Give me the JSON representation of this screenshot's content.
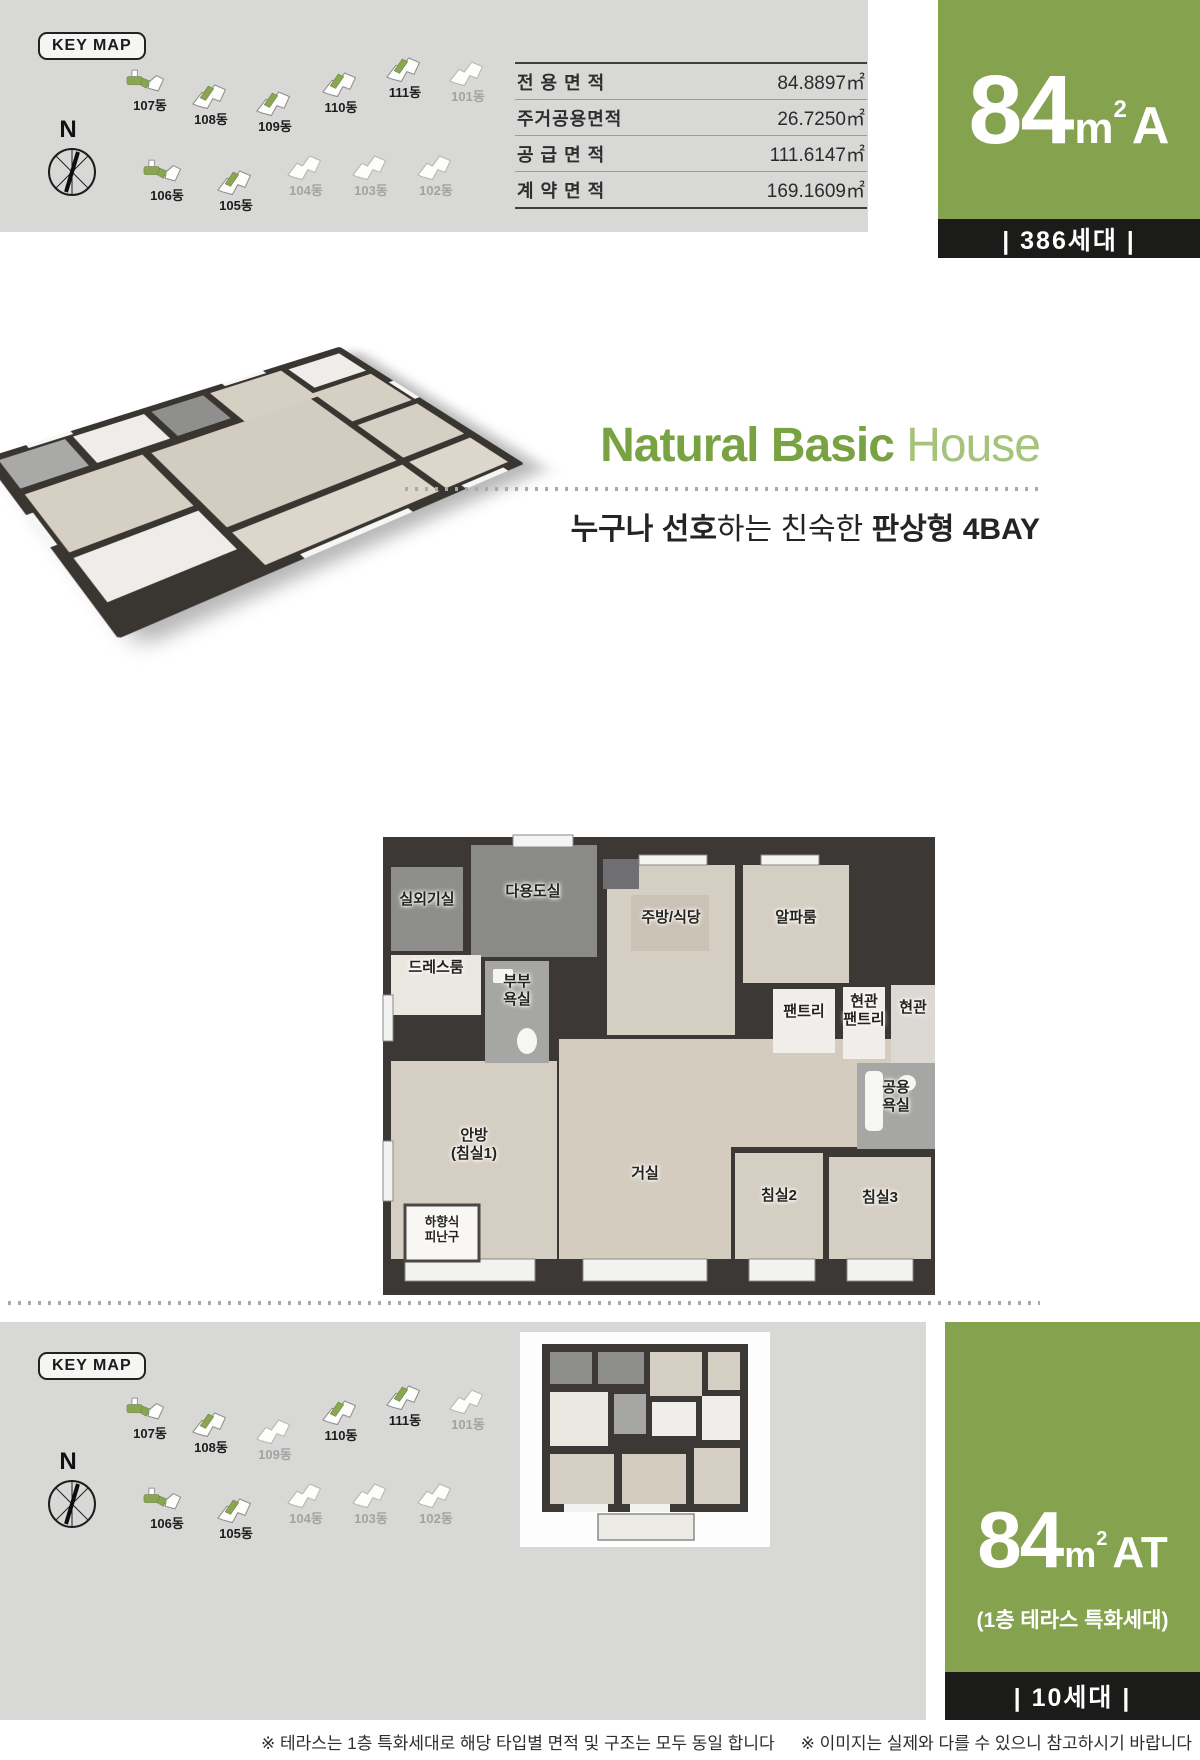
{
  "colors": {
    "accent_green": "#85a24e",
    "title_green": "#79a343",
    "title_green_light": "#a6c37c",
    "bar_black": "#1b1b19",
    "panel_gray": "#d8d9d7"
  },
  "top": {
    "keymap": {
      "title": "KEY MAP",
      "compass": "N",
      "rows": [
        [
          {
            "name": "107동",
            "variant": "bar",
            "active": true
          },
          {
            "name": "108동",
            "variant": "plain",
            "active": true
          },
          {
            "name": "109동",
            "variant": "plain",
            "active": true
          },
          {
            "name": "110동",
            "variant": "plain",
            "active": true
          },
          {
            "name": "111동",
            "variant": "plain",
            "active": true
          },
          {
            "name": "101동",
            "variant": "plain",
            "active": false
          }
        ],
        [
          {
            "name": "106동",
            "variant": "bar",
            "active": true
          },
          {
            "name": "105동",
            "variant": "plain",
            "active": true
          },
          {
            "name": "104동",
            "variant": "plain",
            "active": false
          },
          {
            "name": "103동",
            "variant": "plain",
            "active": false
          },
          {
            "name": "102동",
            "variant": "plain",
            "active": false
          }
        ]
      ]
    },
    "table": {
      "rows": [
        {
          "label": "전 용 면 적",
          "value": "84.8897㎡"
        },
        {
          "label": "주거공용면적",
          "value": "26.7250㎡"
        },
        {
          "label": "공 급 면 적",
          "value": "111.6147㎡"
        },
        {
          "label": "계 약 면 적",
          "value": "169.1609㎡"
        }
      ]
    },
    "badge": {
      "size": "84",
      "unit": "m",
      "sup": "2",
      "type": "A",
      "households": "|  386세대  |"
    }
  },
  "hero": {
    "title_strong": "Natural Basic",
    "title_light": " House",
    "sub_bold1": "누구나 선호",
    "sub_reg": "하는 친숙한 ",
    "sub_bold2": "판상형 4BAY"
  },
  "floorplan": {
    "rooms": [
      {
        "label": "실외기실"
      },
      {
        "label": "다용도실"
      },
      {
        "label": "주방/식당"
      },
      {
        "label": "알파룸"
      },
      {
        "label": "드레스룸"
      },
      {
        "label": "부부\n욕실"
      },
      {
        "label": "팬트리"
      },
      {
        "label": "현관\n팬트리"
      },
      {
        "label": "현관"
      },
      {
        "label": "공용\n욕실"
      },
      {
        "label": "안방\n(침실1)"
      },
      {
        "label": "거실"
      },
      {
        "label": "침실2"
      },
      {
        "label": "침실3"
      },
      {
        "label": "하향식\n피난구"
      }
    ]
  },
  "bottom": {
    "keymap": {
      "title": "KEY MAP",
      "compass": "N",
      "rows": [
        [
          {
            "name": "107동",
            "variant": "bar",
            "active": true
          },
          {
            "name": "108동",
            "variant": "plain",
            "active": true
          },
          {
            "name": "109동",
            "variant": "plain",
            "active": false
          },
          {
            "name": "110동",
            "variant": "plain",
            "active": true
          },
          {
            "name": "111동",
            "variant": "plain",
            "active": true
          },
          {
            "name": "101동",
            "variant": "plain",
            "active": false
          }
        ],
        [
          {
            "name": "106동",
            "variant": "bar",
            "active": true
          },
          {
            "name": "105동",
            "variant": "plain",
            "active": true
          },
          {
            "name": "104동",
            "variant": "plain",
            "active": false
          },
          {
            "name": "103동",
            "variant": "plain",
            "active": false
          },
          {
            "name": "102동",
            "variant": "plain",
            "active": false
          }
        ]
      ]
    },
    "badge": {
      "size": "84",
      "unit": "m",
      "sup": "2",
      "type": "AT",
      "subtitle": "(1층 테라스 특화세대)",
      "households": "|  10세대  |"
    }
  },
  "footnotes": {
    "a": "※ 테라스는 1층 특화세대로 해당 타입별 면적 및 구조는 모두 동일 합니다",
    "b": "※ 이미지는 실제와 다를 수 있으니 참고하시기 바랍니다"
  }
}
